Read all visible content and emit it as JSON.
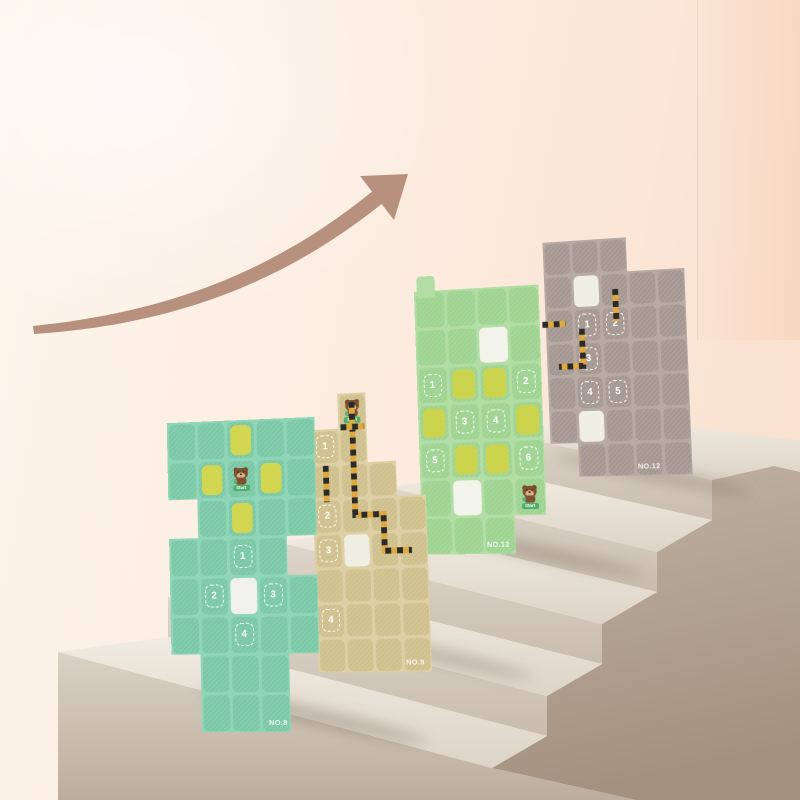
{
  "scene": {
    "arrow_color": "#b8917e",
    "wall_left_color": "#fdf5ec",
    "wall_right_color": "#f9dfcd",
    "staircase": {
      "step_count": 5,
      "top_color": "#ece5da",
      "front_color": "#d7cfc2",
      "side_color": "#b2a294"
    }
  },
  "boards": [
    {
      "label": "NO.8",
      "palette": {
        "board": "#8fd6b9",
        "cell": "#7ac8a6",
        "yellow": "#d3d650",
        "white": "#f0f1e9"
      },
      "grid": [
        [
          "c",
          "c",
          "y",
          "c",
          "c"
        ],
        [
          "c",
          "y",
          "B",
          "y",
          "c"
        ],
        [
          "_",
          "c",
          "y",
          "c",
          "c"
        ],
        [
          "c",
          "c",
          "1",
          "c",
          "_"
        ],
        [
          "c",
          "2",
          "w",
          "3",
          "c"
        ],
        [
          "c",
          "c",
          "4",
          "c",
          "c"
        ],
        [
          "_",
          "c",
          "c",
          "c",
          "_"
        ],
        [
          "_",
          "c",
          "c",
          "c",
          "_"
        ]
      ],
      "hazards": [],
      "bear_sign": "Start"
    },
    {
      "label": "NO.9",
      "palette": {
        "board": "#ddd0a4",
        "cell": "#cfc08d",
        "yellow": "#d6cf5a",
        "white": "#efeee2"
      },
      "grid": [
        [
          "_",
          "B",
          "_",
          "_"
        ],
        [
          "1",
          "c",
          "_",
          "_"
        ],
        [
          "c",
          "c",
          "c",
          "_"
        ],
        [
          "2",
          "c",
          "c",
          "c"
        ],
        [
          "3",
          "w",
          "c",
          "c"
        ],
        [
          "c",
          "c",
          "c",
          "c"
        ],
        [
          "4",
          "c",
          "c",
          "c"
        ],
        [
          "c",
          "c",
          "c",
          "c"
        ]
      ],
      "hazards": [
        [
          [
            1.5,
            0.25
          ],
          [
            1.5,
            3.5
          ],
          [
            2.5,
            3.5
          ],
          [
            2.5,
            4.55
          ],
          [
            3.45,
            4.55
          ]
        ],
        [
          [
            0.5,
            2.05
          ],
          [
            0.5,
            3.1
          ]
        ],
        [
          [
            1.08,
            0.97
          ],
          [
            1.92,
            0.97
          ]
        ]
      ],
      "bear_sign": "Start"
    },
    {
      "label": "NO.12",
      "palette": {
        "board": "#b2dda4",
        "cell": "#9ed391",
        "yellow": "#ccd44e",
        "white": "#f2f3ea"
      },
      "grid": [
        [
          "c",
          "c",
          "c",
          "c"
        ],
        [
          "c",
          "c",
          "w",
          "c"
        ],
        [
          "1",
          "y",
          "y",
          "2"
        ],
        [
          "y",
          "3",
          "4",
          "y"
        ],
        [
          "5",
          "y",
          "y",
          "6"
        ],
        [
          "c",
          "w",
          "c",
          "B"
        ],
        [
          "c",
          "c",
          "c",
          "_"
        ]
      ],
      "hazards": [],
      "bear_sign": "Start"
    },
    {
      "label": "NO.12",
      "palette": {
        "board": "#b6aaa3",
        "cell": "#a59791",
        "yellow": "#d6cf5a",
        "white": "#efeee4"
      },
      "grid": [
        [
          "c",
          "c",
          "c",
          "_",
          "_"
        ],
        [
          "c",
          "w",
          "c",
          "c",
          "c"
        ],
        [
          "c",
          "1",
          "2",
          "c",
          "c"
        ],
        [
          "c",
          "3",
          "c",
          "c",
          "c"
        ],
        [
          "c",
          "4",
          "5",
          "c",
          "c"
        ],
        [
          "c",
          "w",
          "c",
          "c",
          "c"
        ],
        [
          "_",
          "c",
          "c",
          "c",
          "c"
        ]
      ],
      "hazards": [
        [
          [
            2.55,
            1.5
          ],
          [
            2.55,
            2.45
          ]
        ],
        [
          [
            -0.12,
            2.45
          ],
          [
            0.72,
            2.45
          ]
        ],
        [
          [
            1.3,
            2.62
          ],
          [
            1.3,
            3.72
          ],
          [
            0.42,
            3.72
          ]
        ]
      ],
      "bear_sign": "Start"
    }
  ]
}
